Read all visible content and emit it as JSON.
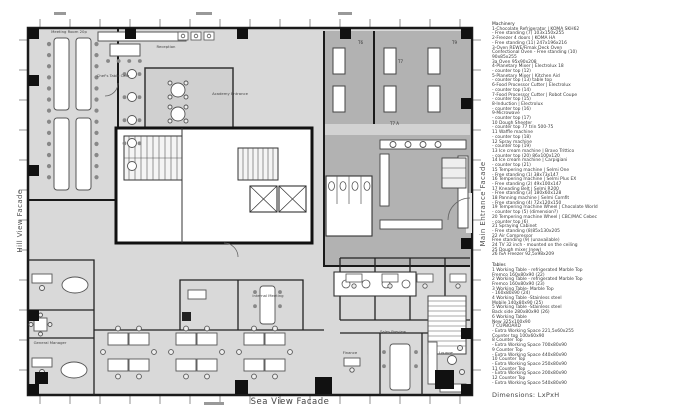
{
  "plan": {
    "facade_left": "Hill View Facade",
    "facade_right": "Main Entrance Facade",
    "facade_bottom": "Sea View Facade",
    "dimensions_note": "Dimensions: LxPxH",
    "rooms": {
      "meeting": "Meeting Room 20p",
      "reception": "Reception",
      "cafe": "Chef's Table Cafe",
      "academy": "Academy Entrance",
      "internal_meeting": "Internal Meeting",
      "general_manager": "General Manager",
      "sales": "Sales Preview",
      "lounge": "Lounge",
      "finance": "Finance",
      "t6": "T6",
      "t7": "T7",
      "t7a": "T7 A",
      "t9": "T9"
    }
  },
  "legend": {
    "machinery_title": "Machinery",
    "machinery": [
      "1-Chocolate Refrigerator  | KOMA SKH62",
      "- Free standing (7) 103x150x255",
      "2-Freezer 4 doors | KOMA HA",
      "- Free standing (11) 247x196x216",
      "3-Oven REWE/Fimak Deck Oven",
      "Confectional Oven - Free standing (10)",
      "90x85x255",
      "3a Oven 95x90x208",
      "4-Planetary Mixer | Electrolux 18",
      "- counter top (12)",
      "5-Planetary Mixer | Kitchen Aid",
      "- counter top (13) table top",
      "6-Food Processor Cutter | Electrolux",
      "- counter top (14)",
      "7-Food Processor Cutter | Robot Coupe",
      "- counter top (15)",
      "8-Induction | Electrolux",
      "- counter top (16)",
      "9-Microwave",
      "- counter top (17)",
      "10 Dough Sheeter",
      "- counter top 77 trin 500-75",
      "11 Waffle machine",
      "- counter top (18)",
      "12 Spray machine",
      "- counter top (19)",
      "13 Ice cream machine | Bravo Trittico",
      "- counter top (20) 86x100x120",
      "14 Ice cream machine | Carpigiani",
      "- counter top (21)",
      "15 Tempering machine | Selmi One",
      "- Free standing (1) 38x73x147",
      "16 Tempering machine | Selmi Plus EX",
      "- Free standing (2) 49x100x147",
      "17 Kneading Belt | Selmi R200",
      "- Free standing (3) 180x60x128",
      "18 Panning machine | Selmi Comfit",
      "- Free standing (4) 72x120x150",
      "19 Tempering machine Wheel | Chocolate World",
      "- counter top (5) (dimension?)",
      "20 Tempering machine Wheel | CBC/MAC Cebec",
      "- counter top (6)",
      "21 Spraying Cabinet",
      "- Free standing (8)85x130x205",
      "22 Air Compressor",
      "Free standing (9) (unavailable)",
      "24 TV 32 inch - mounted on the ceiling",
      "25 Dough mixer (new)",
      "26 ISA Freezer 92,5x98x209"
    ],
    "tables_title": "Tables",
    "tables": [
      "1 Working Table - refrigerated Marble Top",
      "Fremco 160x80x90   (22)",
      "2 Working Table - refrigerated Marble Top",
      "Fremco 160x80x90  (23)",
      "3 Working Table- Marble Top",
      "- 160x80x90   (24)",
      "4 Working Table -Stainless steel",
      "Mobile  140x80x90  (25)",
      "5 Working Table -Stainless steel",
      "Back side  280x80x90  (26)",
      "6 Working Table",
      "New  325x100x90",
      "7 CUPBOARD",
      "- Extra Working Space  221,5x60x255",
      "Counter top  100x60x90",
      "8 Counter Top",
      "- Extra Working Space  700x80x90",
      "9 Counter Top",
      "- Extra Working Space  440x80x90",
      "10 Counter Top",
      "- Extra Working Space  250x80x90",
      "11 Counter Top",
      "- Extra Working Space  200x80x90",
      "12 Counter Top",
      "- Extra Working Space  540x80x90"
    ]
  },
  "colors": {
    "floor": "#d9d9d9",
    "dark_zone": "#b2b2b2",
    "wall": "#1a1a1a",
    "furniture": "#ffffff"
  }
}
